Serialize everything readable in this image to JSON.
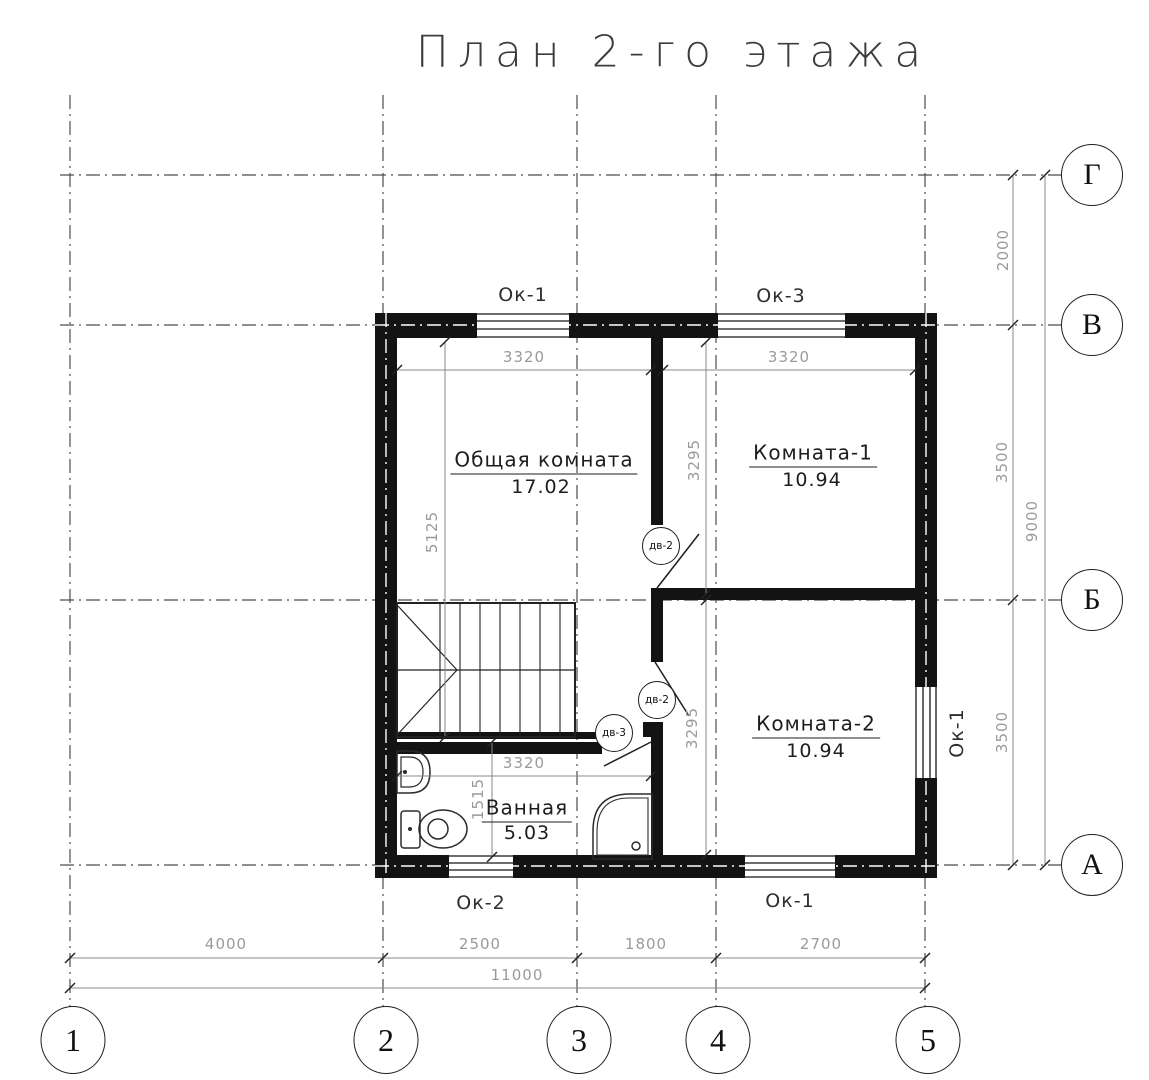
{
  "title": "План 2-го этажа",
  "colors": {
    "line": "#1a1a1a",
    "dim_text": "#9a9a9a",
    "background": "#ffffff"
  },
  "rooms": {
    "living": {
      "name": "Общая комната",
      "area": "17.02"
    },
    "room1": {
      "name": "Комната-1",
      "area": "10.94"
    },
    "room2": {
      "name": "Комната-2",
      "area": "10.94"
    },
    "bath": {
      "name": "Ванная",
      "area": "5.03"
    }
  },
  "windows": {
    "top_left": "Ок-1",
    "top_right": "Ок-3",
    "bottom_left": "Ок-2",
    "bottom_right": "Ок-1",
    "right_side": "Ок-1"
  },
  "doors": {
    "room1_door": "дв-2",
    "room2_door": "дв-2",
    "bath_door": "дв-3"
  },
  "dims": {
    "living_width": "3320",
    "room1_width": "3320",
    "living_height": "5125",
    "corridor_upper": "3295",
    "corridor_lower": "3295",
    "bath_width": "3320",
    "bath_height": "1515",
    "bottom": {
      "s1": "4000",
      "s2": "2500",
      "s3": "1800",
      "s4": "2700",
      "total": "11000"
    },
    "right": {
      "s1": "2000",
      "s2": "3500",
      "s3": "3500",
      "total": "9000"
    }
  },
  "axes": {
    "cols": {
      "c1": "1",
      "c2": "2",
      "c3": "3",
      "c4": "4",
      "c5": "5"
    },
    "rows": {
      "r1": "Г",
      "r2": "В",
      "r3": "Б",
      "r4": "А"
    }
  }
}
